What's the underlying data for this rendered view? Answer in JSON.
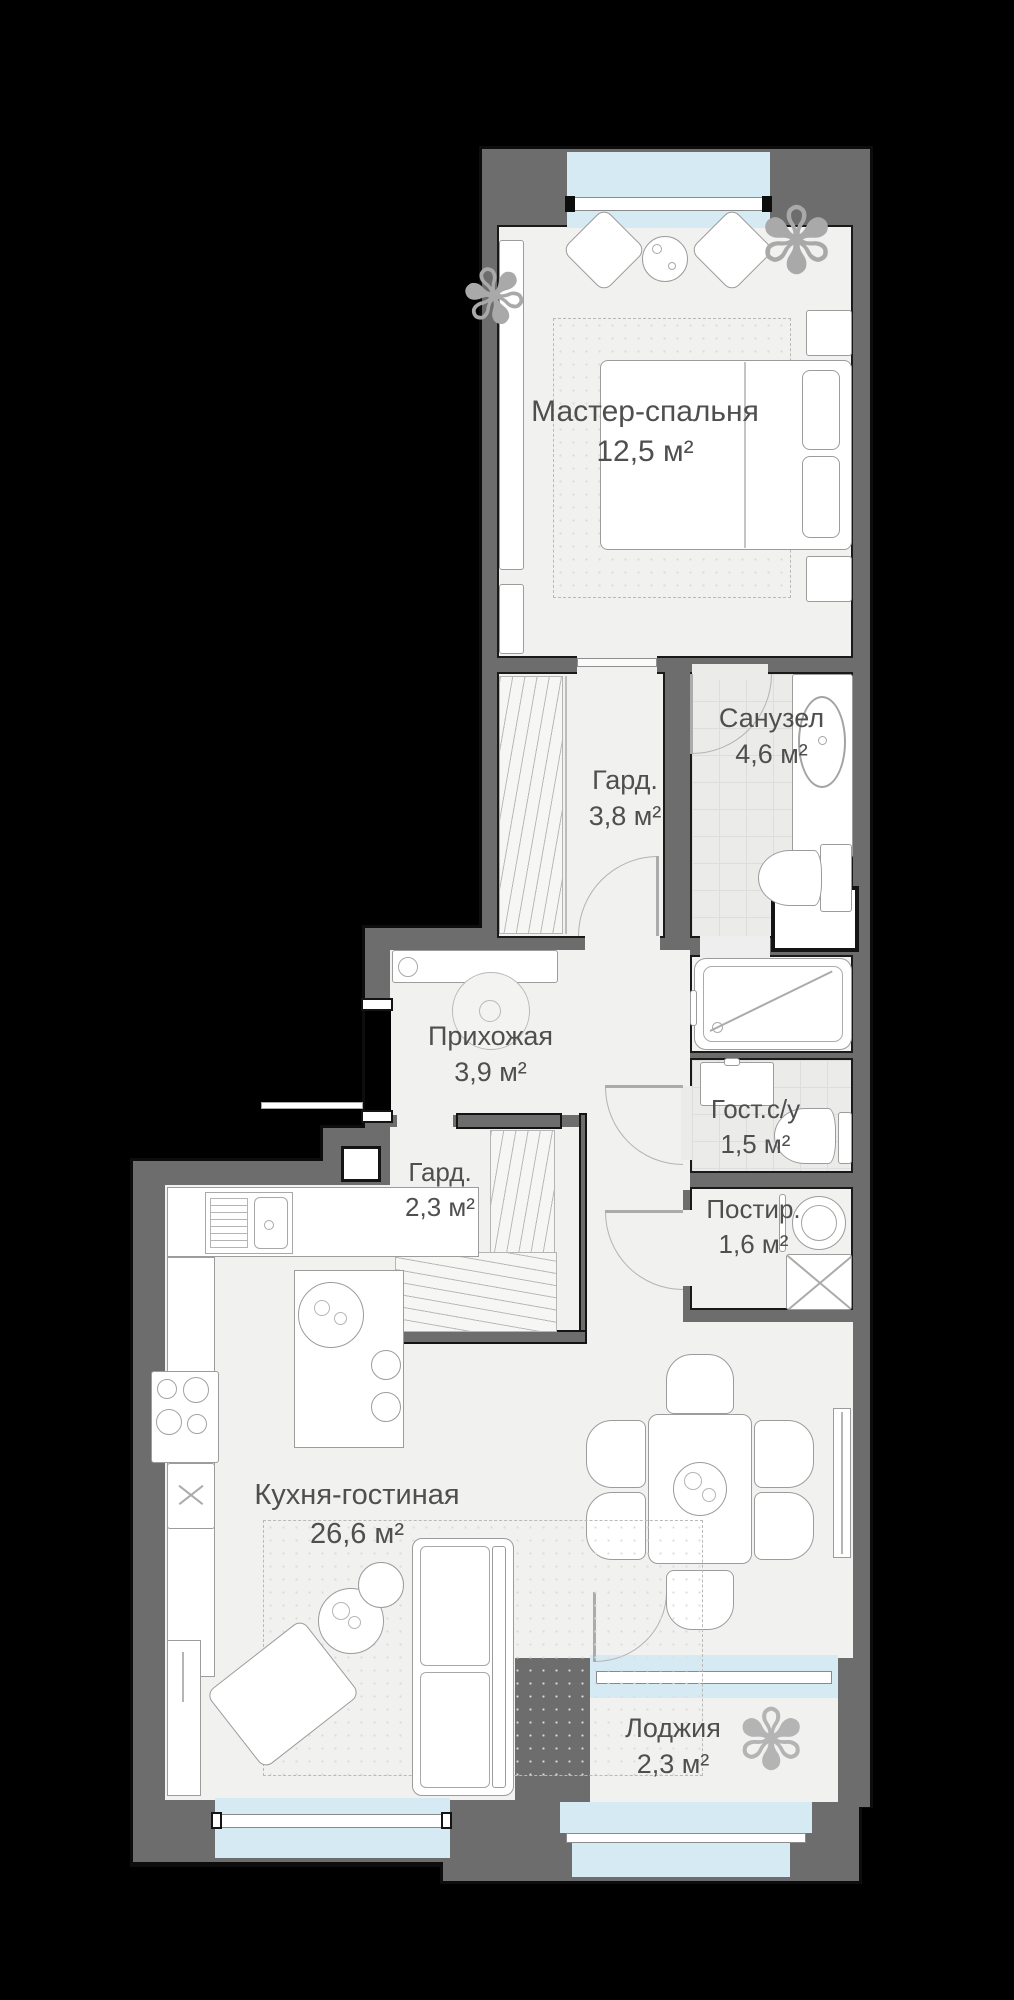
{
  "plan": {
    "type": "apartment-floor-plan",
    "rooms": [
      {
        "name": "Мастер-спальня",
        "area": "12,5 м²"
      },
      {
        "name": "Санузел",
        "area": "4,6 м²"
      },
      {
        "name": "Гард.",
        "area": "3,8 м²"
      },
      {
        "name": "Прихожая",
        "area": "3,9 м²"
      },
      {
        "name": "Гард.",
        "area": "2,3 м²"
      },
      {
        "name": "Гост.с/у",
        "area": "1,5 м²"
      },
      {
        "name": "Постир.",
        "area": "1,6 м²"
      },
      {
        "name": "Кухня-гостиная",
        "area": "26,6 м²"
      },
      {
        "name": "Лоджия",
        "area": "2,3 м²"
      }
    ],
    "icons": {
      "plant": "✾"
    },
    "colors": {
      "background": "#000000",
      "wall": "#6d6d6d",
      "wall_outline": "#141414",
      "floor": "#f1f1f0",
      "tile": "#ebebea",
      "window_glass": "#d6eaf3",
      "window_sill": "#ffffff",
      "furniture_stroke": "#9c9c9c",
      "label_text": "#4f4f4f"
    }
  }
}
